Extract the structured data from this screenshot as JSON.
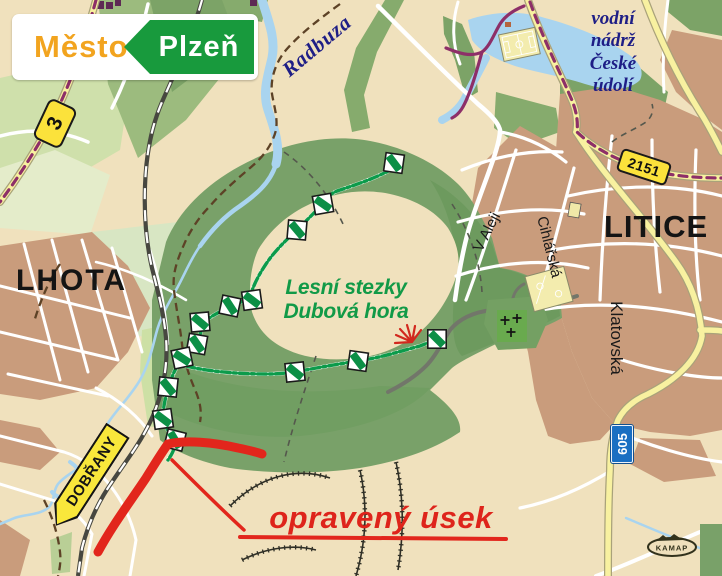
{
  "logo": {
    "city_label": "Město",
    "city_name": "Plzeň"
  },
  "labels": {
    "river": "Radbuza",
    "reservoir": "vodní\nnádrž\nČeské\núdolí",
    "trail_area": "Lesní stezky\nDubová hora",
    "repaired_section": "opravený úsek"
  },
  "towns": {
    "west": "LHOTA",
    "east": "LITICE"
  },
  "streets": {
    "v_aleji": "V Aleji",
    "cihlarska": "Cihlářská",
    "klatovska": "Klatovská"
  },
  "road_shields": {
    "route_3": "3",
    "route_2151": "2151",
    "route_605": "605"
  },
  "direction_sign": {
    "destination": "DOBŘANY"
  },
  "map_credit": "KAMAP",
  "colors": {
    "background_beige": "#f0e1bd",
    "forest_green": "#79a169",
    "water_blue": "#a9d4ef",
    "urban_brown": "#c99c7c",
    "road_yellow": "#f8f1a0",
    "trail_green": "#0c9b4b",
    "marked_trail_purple": "#8d2f68",
    "repaired_red": "#e2261c",
    "water_label_blue": "#1e1e86"
  }
}
